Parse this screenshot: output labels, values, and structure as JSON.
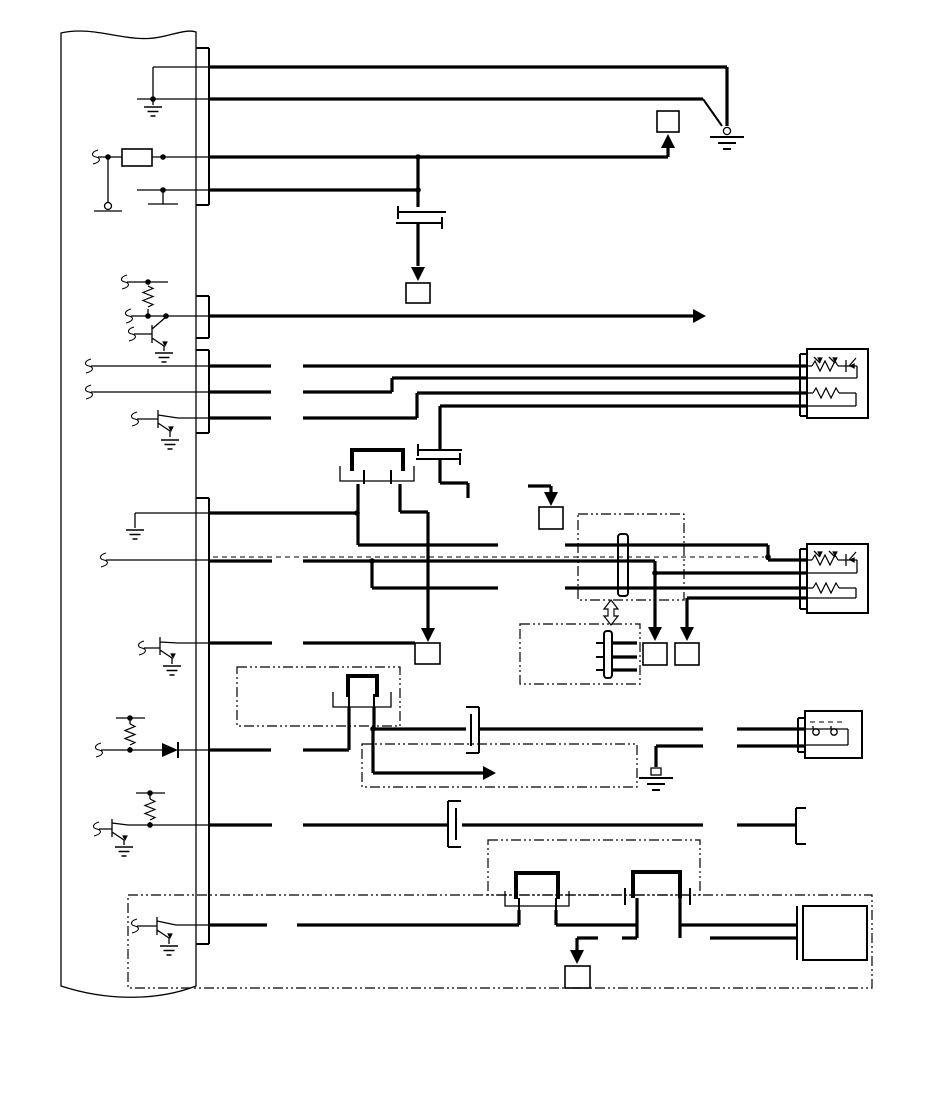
{
  "canvas": {
    "width": 950,
    "height": 1103,
    "background": "#ffffff",
    "line_color": "#000000"
  },
  "diagram": {
    "type": "wiring-schematic",
    "visible_text": [],
    "components": [
      {
        "id": "control-module",
        "label": "control module (torn-edge block)"
      },
      {
        "id": "module-connector-bar",
        "label": "module pin connector bar"
      },
      {
        "id": "sensor-top-right",
        "label": "4-pin resistive sensor"
      },
      {
        "id": "sensor-mid-right",
        "label": "4-pin resistive sensor"
      },
      {
        "id": "contact-switch-right",
        "label": "2-pin contact switch"
      },
      {
        "id": "actuator-bottom-right",
        "label": "actuator block"
      },
      {
        "id": "inline-connectors",
        "label": "inline harness connectors"
      },
      {
        "id": "reference-boxes",
        "label": "off-page reference boxes with arrows"
      },
      {
        "id": "ground-symbols",
        "label": "chassis ground symbols"
      },
      {
        "id": "transistors",
        "label": "output driver transistors"
      },
      {
        "id": "resistors",
        "label": "pull-up resistors"
      },
      {
        "id": "diode",
        "label": "blocking diode"
      },
      {
        "id": "harness-boundaries",
        "label": "dash-dot harness boundary boxes"
      },
      {
        "id": "shield-wire",
        "label": "dashed shield wire"
      }
    ]
  }
}
